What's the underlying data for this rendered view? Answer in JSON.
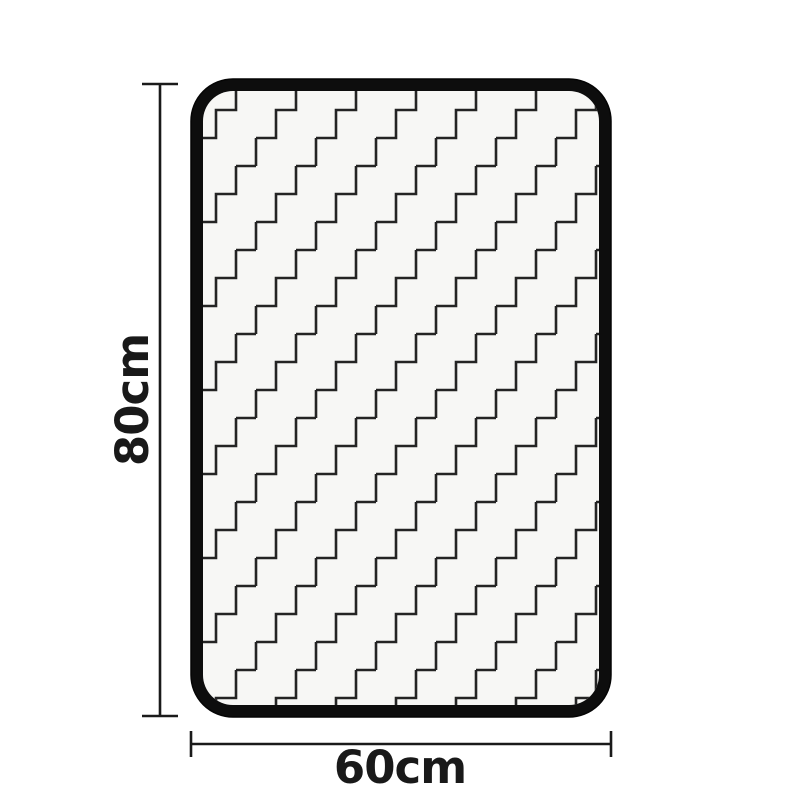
{
  "page": {
    "background_color": "#ffffff",
    "description": "Product dimension diagram of a rectangular mat with rounded black edge binding and a black-and-white zigzag staircase pattern"
  },
  "mat": {
    "pattern_style": "zigzag-staircase",
    "fill_color": "#f7f7f5",
    "border_color": "#0d0d0d",
    "pattern_line_color": "#242424"
  },
  "dimensions": {
    "line_color": "#1a1a1a",
    "height": {
      "label": "80cm"
    },
    "width": {
      "label": "60cm"
    }
  }
}
